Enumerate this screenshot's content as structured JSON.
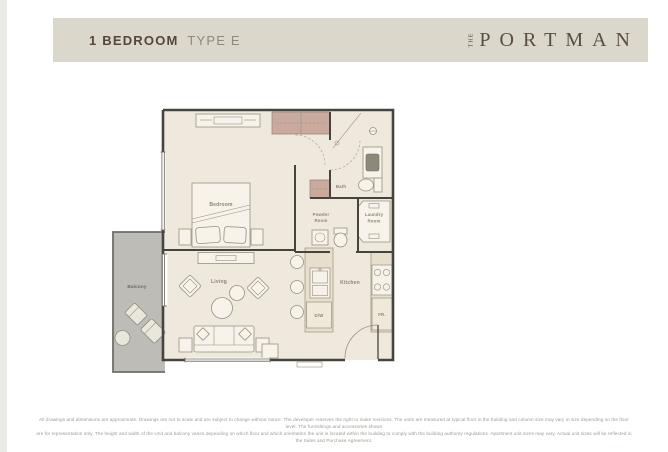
{
  "header": {
    "title_bold": "1 BEDROOM",
    "title_light": "TYPE E",
    "brand_prefix": "THE",
    "brand_name": "PORTMAN"
  },
  "plan": {
    "labels": {
      "bedroom": "Bedroom",
      "living": "Living",
      "kitchen": "Kitchen",
      "bath": "Bath",
      "balcony": "Balcony",
      "powder_line1": "Powder",
      "powder_line2": "Room",
      "laundry_line1": "Laundry",
      "laundry_line2": "Room",
      "dishwasher": "D/W",
      "fridge": "FR."
    }
  },
  "footer": {
    "line1": "All drawings and dimensions are approximate. Drawings are not to scale and are subject to change without notice. The developer reserves the right to make revisions. The units are measured at typical floor in the building and column size may vary in size depending on the floor level. The furnishings and accessories shown",
    "line2": "are for representation only. The height and width of the Unit and balcony varies depending on which floor and which orientation the unit is located within the building to comply with the building authority regulations. Apartment unit sizes may vary. Actual unit sizes will be reflected in the Sales and Purchase Agreement."
  },
  "colors": {
    "band": "#dbd7cb",
    "title": "#54463b",
    "subtitle": "#8f897d",
    "brand": "#5a4d42",
    "wall": "#45443f",
    "floor": "#efe9dd",
    "balcony": "#bdbcb7",
    "closet": "#c9aa9d",
    "label": "#8a8478",
    "disclaimer": "#9e9991"
  }
}
